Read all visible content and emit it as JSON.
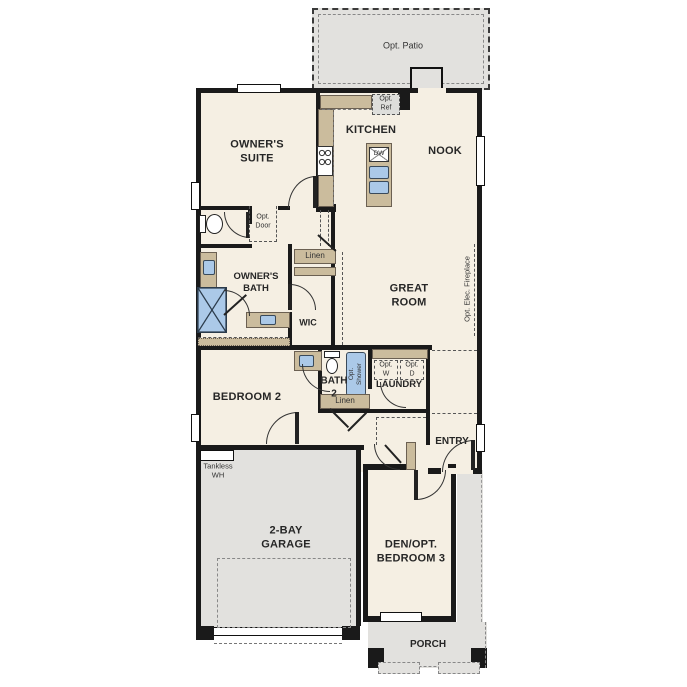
{
  "colors": {
    "wall": "#1a1a1a",
    "room_fill": "#f5efe3",
    "paved_fill": "#e2e1de",
    "cabinet_fill": "#cbbc9d",
    "fixture_blue": "#abc9e8"
  },
  "rooms": {
    "opt_patio": {
      "label": "Opt. Patio"
    },
    "owners_suite": {
      "line1": "OWNER'S",
      "line2": "SUITE"
    },
    "kitchen": {
      "label": "KITCHEN"
    },
    "nook": {
      "label": "NOOK"
    },
    "owners_bath": {
      "line1": "OWNER'S",
      "line2": "BATH"
    },
    "wic": {
      "label": "WIC"
    },
    "great_room": {
      "line1": "GREAT",
      "line2": "ROOM"
    },
    "bedroom_2": {
      "label": "BEDROOM 2"
    },
    "bath_2": {
      "line1": "BATH",
      "line2": "2"
    },
    "laundry": {
      "label": "LAUNDRY"
    },
    "entry": {
      "label": "ENTRY"
    },
    "garage": {
      "line1": "2-BAY",
      "line2": "GARAGE"
    },
    "den": {
      "line1": "DEN/OPT.",
      "line2": "BEDROOM 3"
    },
    "porch": {
      "label": "PORCH"
    }
  },
  "annotations": {
    "opt_ref": {
      "line1": "Opt.",
      "line2": "Ref"
    },
    "opt_door": {
      "line1": "Opt.",
      "line2": "Door"
    },
    "linen_owners": {
      "label": "Linen"
    },
    "linen_hall": {
      "label": "Linen"
    },
    "opt_elec_fireplace": {
      "label": "Opt. Elec. Fireplace"
    },
    "opt_shower": {
      "line1": "Opt.",
      "line2": "Shower"
    },
    "opt_washer": {
      "line1": "Opt.",
      "line2": "W"
    },
    "opt_dryer": {
      "line1": "Opt.",
      "line2": "D"
    },
    "tankless_wh": {
      "line1": "Tankless",
      "line2": "WH"
    },
    "dishwasher": {
      "label": "DW"
    }
  }
}
